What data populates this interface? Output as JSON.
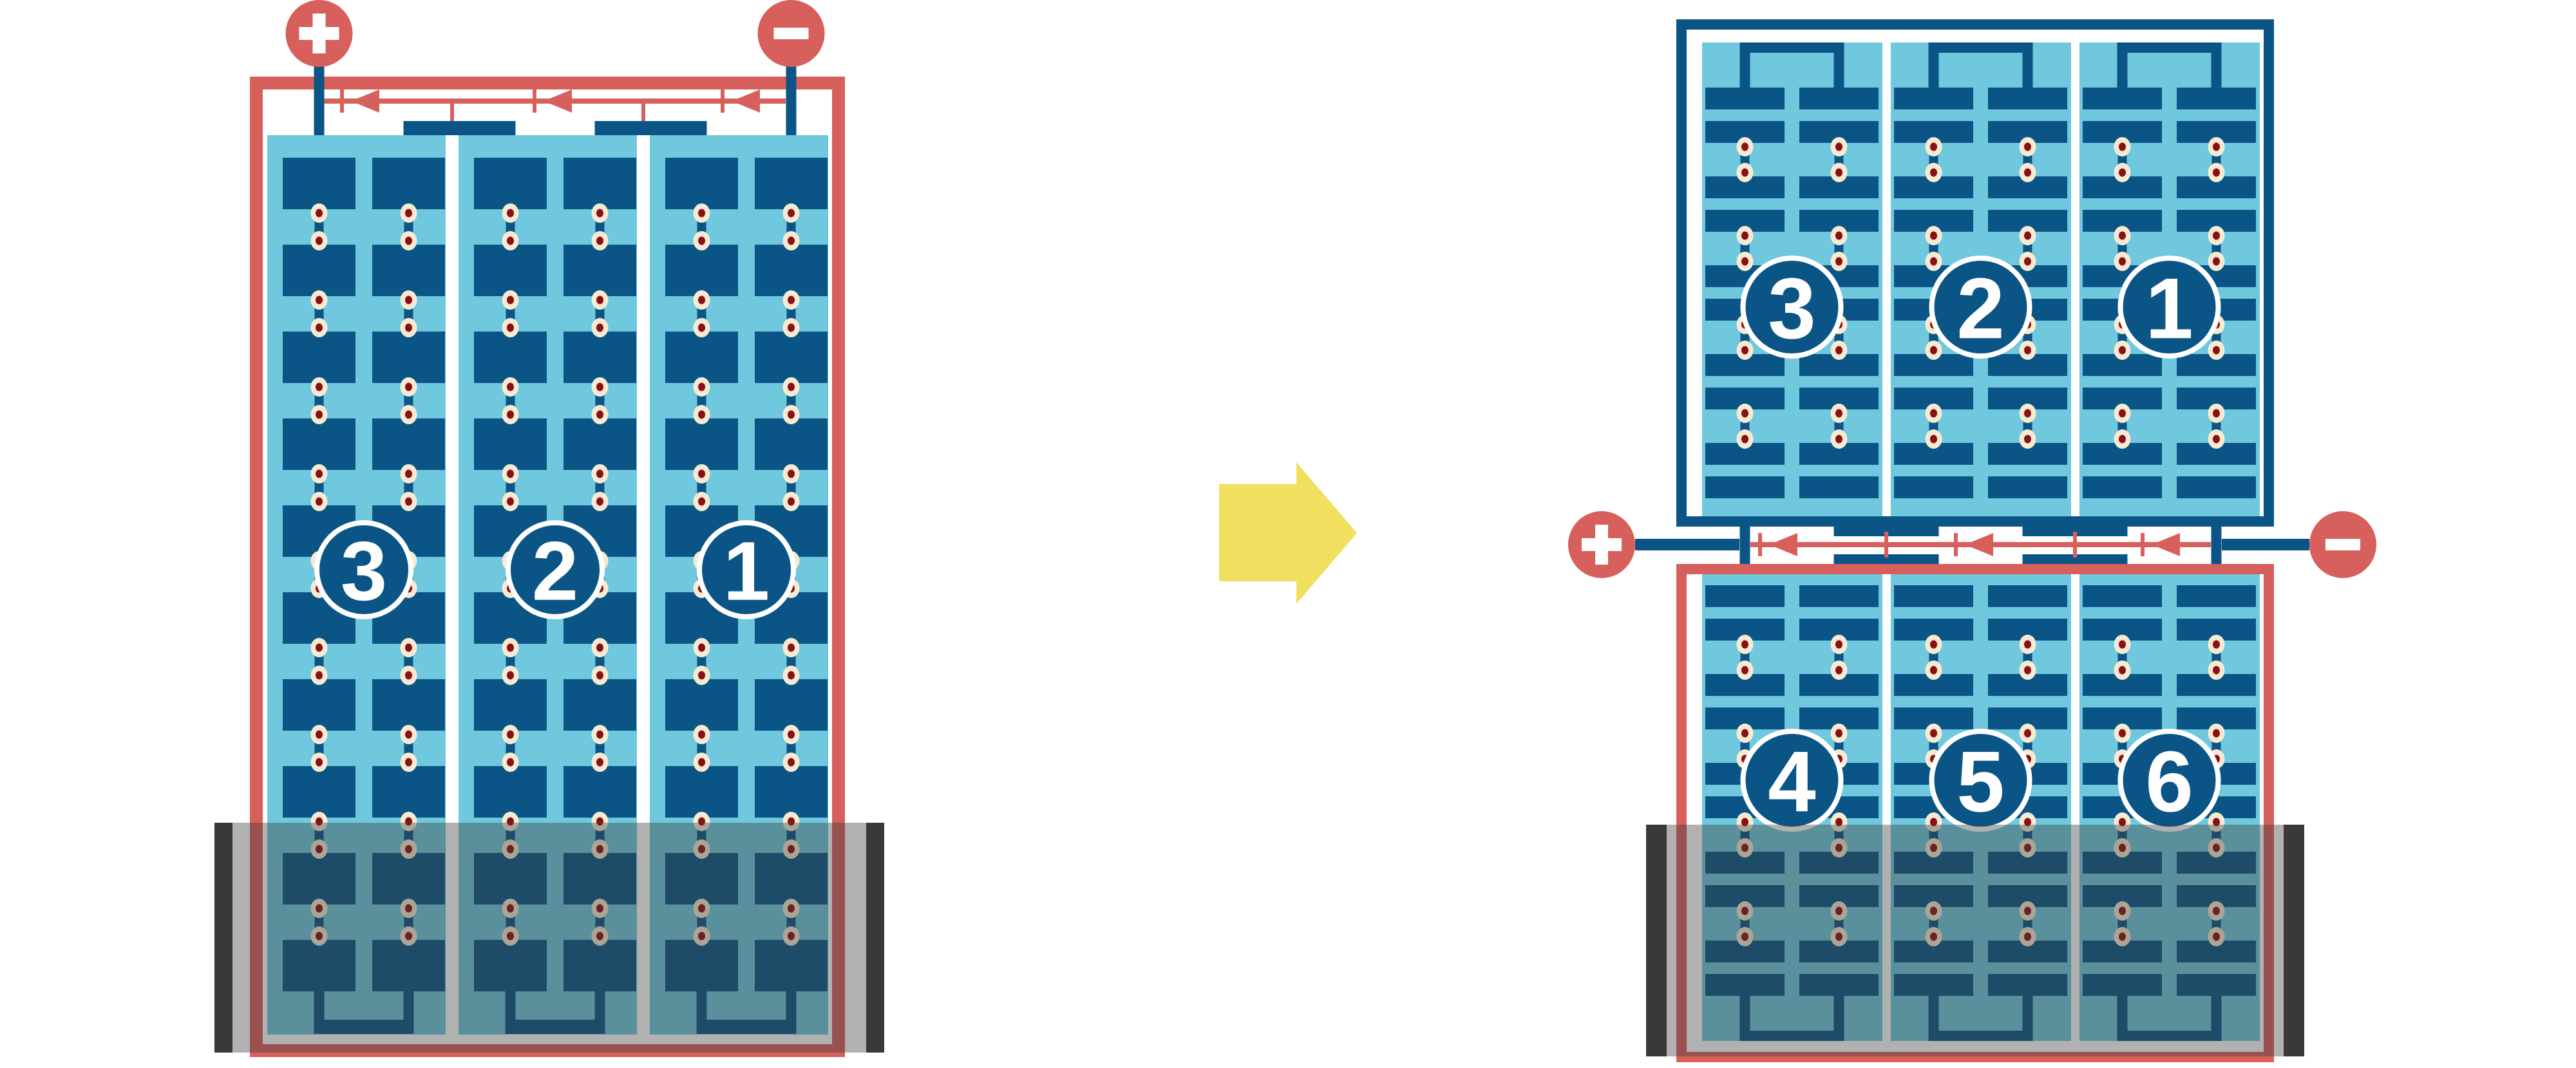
{
  "left_battery": {
    "cell_labels": [
      "3",
      "2",
      "1"
    ],
    "positive_terminal": "+",
    "negative_terminal": "−"
  },
  "right_battery": {
    "top_row_cell_labels": [
      "3",
      "2",
      "1"
    ],
    "bottom_row_cell_labels": [
      "4",
      "5",
      "6"
    ],
    "positive_terminal": "+",
    "negative_terminal": "−"
  },
  "icons": {
    "positive_terminal": "plus-circle-icon",
    "negative_terminal": "minus-circle-icon",
    "current_direction": "left-arrowhead-icons",
    "transform": "right-block-arrow-icon"
  },
  "colors": {
    "red": "#D7605C",
    "dark_blue": "#0B5586",
    "cyan": "#6FC8DD",
    "bead_cream": "#F6EBD2",
    "bead_dot": "#8A1016",
    "yellow": "#F1DF5F",
    "container_dark": "#3B3838",
    "container_wash": "rgba(60,60,60,0.4)",
    "white": "#FFFFFF"
  }
}
